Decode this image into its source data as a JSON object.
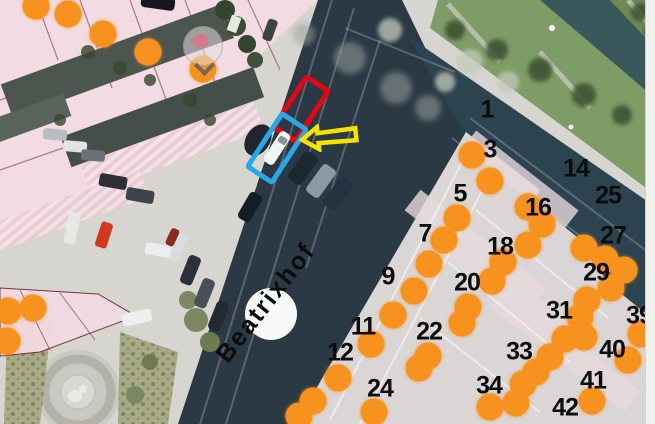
{
  "map": {
    "street_label": "Beatrixhof",
    "marker_color": "#f7921e",
    "number_color": "#0c0c0c",
    "numbers": [
      {
        "label": "1",
        "x": 487,
        "y": 110
      },
      {
        "label": "3",
        "x": 490,
        "y": 150
      },
      {
        "label": "5",
        "x": 460,
        "y": 194
      },
      {
        "label": "7",
        "x": 425,
        "y": 234
      },
      {
        "label": "9",
        "x": 388,
        "y": 277
      },
      {
        "label": "11",
        "x": 363,
        "y": 327
      },
      {
        "label": "12",
        "x": 340,
        "y": 353
      },
      {
        "label": "14",
        "x": 576,
        "y": 169
      },
      {
        "label": "16",
        "x": 538,
        "y": 208
      },
      {
        "label": "18",
        "x": 500,
        "y": 247
      },
      {
        "label": "20",
        "x": 467,
        "y": 283
      },
      {
        "label": "22",
        "x": 429,
        "y": 332
      },
      {
        "label": "24",
        "x": 380,
        "y": 389
      },
      {
        "label": "25",
        "x": 608,
        "y": 196
      },
      {
        "label": "27",
        "x": 613,
        "y": 236
      },
      {
        "label": "29",
        "x": 596,
        "y": 273
      },
      {
        "label": "31",
        "x": 559,
        "y": 311
      },
      {
        "label": "33",
        "x": 519,
        "y": 352
      },
      {
        "label": "34",
        "x": 489,
        "y": 386
      },
      {
        "label": "39",
        "x": 639,
        "y": 316
      },
      {
        "label": "40",
        "x": 612,
        "y": 350
      },
      {
        "label": "41",
        "x": 593,
        "y": 381
      },
      {
        "label": "42",
        "x": 565,
        "y": 408
      }
    ],
    "dots": [
      {
        "x": 36,
        "y": 6
      },
      {
        "x": 68,
        "y": 14
      },
      {
        "x": 103,
        "y": 34
      },
      {
        "x": 148,
        "y": 52
      },
      {
        "x": 203,
        "y": 69
      },
      {
        "x": 8,
        "y": 311
      },
      {
        "x": 33,
        "y": 308
      },
      {
        "x": 7,
        "y": 341
      },
      {
        "x": 472,
        "y": 155
      },
      {
        "x": 490,
        "y": 181
      },
      {
        "x": 457,
        "y": 218
      },
      {
        "x": 444,
        "y": 240
      },
      {
        "x": 429,
        "y": 264
      },
      {
        "x": 414,
        "y": 291
      },
      {
        "x": 393,
        "y": 315
      },
      {
        "x": 371,
        "y": 344
      },
      {
        "x": 338,
        "y": 378
      },
      {
        "x": 313,
        "y": 401
      },
      {
        "x": 299,
        "y": 416
      },
      {
        "x": 528,
        "y": 207
      },
      {
        "x": 542,
        "y": 224
      },
      {
        "x": 528,
        "y": 245
      },
      {
        "x": 503,
        "y": 262
      },
      {
        "x": 492,
        "y": 281
      },
      {
        "x": 468,
        "y": 307
      },
      {
        "x": 462,
        "y": 323
      },
      {
        "x": 428,
        "y": 356
      },
      {
        "x": 419,
        "y": 368
      },
      {
        "x": 374,
        "y": 412
      },
      {
        "x": 584,
        "y": 248
      },
      {
        "x": 605,
        "y": 259
      },
      {
        "x": 624,
        "y": 270
      },
      {
        "x": 611,
        "y": 288
      },
      {
        "x": 587,
        "y": 300
      },
      {
        "x": 580,
        "y": 317
      },
      {
        "x": 584,
        "y": 337
      },
      {
        "x": 565,
        "y": 339
      },
      {
        "x": 550,
        "y": 357
      },
      {
        "x": 536,
        "y": 372
      },
      {
        "x": 523,
        "y": 384
      },
      {
        "x": 516,
        "y": 403
      },
      {
        "x": 490,
        "y": 407
      },
      {
        "x": 592,
        "y": 401
      },
      {
        "x": 641,
        "y": 334
      },
      {
        "x": 628,
        "y": 360
      }
    ],
    "annotations": {
      "red_box": {
        "color": "#e30613",
        "x": 301,
        "y": 109
      },
      "blue_box": {
        "color": "#2aa7e8",
        "x": 277,
        "y": 148
      },
      "white_car_in_blue_box": {
        "x": 277,
        "y": 148
      },
      "yellow_arrow": {
        "color": "#f6e400",
        "x": 329,
        "y": 137,
        "direction": "left"
      },
      "pin_marker": {
        "color": "#d4798c",
        "x": 203,
        "y": 46
      }
    }
  }
}
